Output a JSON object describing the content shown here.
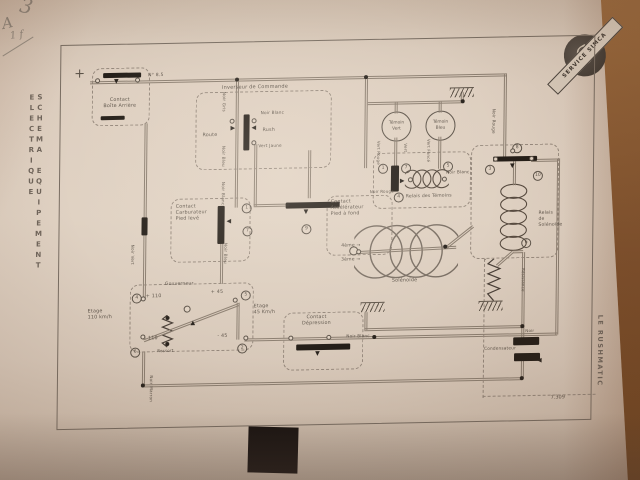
{
  "photo": {
    "handwriting": {
      "mark1": "3",
      "mark2": "A",
      "mark3": "1 f"
    },
    "stamp": {
      "ribbon_text": "SERVICE SIMCA",
      "monogram": "S"
    },
    "colors": {
      "paper": "#dccfc0",
      "wood": "#8a5a33",
      "ink": "#5c5349",
      "wire": "#8b7e70",
      "black": "#241e18"
    }
  },
  "page": {
    "left_margin_title": "SCHEMA EQUIPEMENT ELECTRIQUE",
    "right_margin_title": "LE RUSHMATIC",
    "drawing_number": "7.309"
  },
  "diagram": {
    "temoin_vert": "Témoin\nVert",
    "temoin_bleu": "Témoin\nBleu",
    "labels": [
      {
        "t": "+",
        "x": 74,
        "y": 62,
        "s": 13,
        "n": "plus-terminal-label"
      },
      {
        "t": "Contact\nBoîte Arrière",
        "x": 92,
        "y": 94,
        "w": 56,
        "a": "center",
        "n": "contact-boite-label"
      },
      {
        "t": "N° 8.5",
        "x": 148,
        "y": 70,
        "s": 4.5,
        "n": "wire-gauge-label"
      },
      {
        "t": "Inverseur de Commande",
        "x": 222,
        "y": 83,
        "s": 5,
        "n": "inverseur-label"
      },
      {
        "t": "Route",
        "x": 203,
        "y": 131,
        "n": "route-label"
      },
      {
        "t": "Rush",
        "x": 263,
        "y": 127,
        "n": "rush-label"
      },
      {
        "t": "Noir Blanc",
        "x": 261,
        "y": 109,
        "s": 4.2,
        "n": "wire-label"
      },
      {
        "t": "Vert Jaune",
        "x": 259,
        "y": 142,
        "s": 4.2,
        "n": "wire-label"
      },
      {
        "t": "Noir Gris",
        "x": 227,
        "y": 90,
        "s": 4.2,
        "r": 90,
        "n": "wire-label"
      },
      {
        "t": "Noir Bleu",
        "x": 227,
        "y": 144,
        "s": 4.2,
        "r": 90,
        "n": "wire-label"
      },
      {
        "t": "Noir Blanc",
        "x": 227,
        "y": 180,
        "s": 4.2,
        "r": 90,
        "n": "wire-label"
      },
      {
        "t": "Contact\nCarburateur\nPied levé",
        "x": 177,
        "y": 202,
        "n": "contact-carburateur-label"
      },
      {
        "t": "Contact\nAccélérateur\nPied à fond",
        "x": 332,
        "y": 200,
        "n": "contact-accelerateur-label"
      },
      {
        "t": "Gouverneur",
        "x": 167,
        "y": 279,
        "s": 4.5,
        "n": "gouverneur-label"
      },
      {
        "t": "+ 110",
        "x": 148,
        "y": 291,
        "n": "stage-value"
      },
      {
        "t": "+ 45",
        "x": 213,
        "y": 288,
        "n": "stage-value"
      },
      {
        "t": "- 110",
        "x": 147,
        "y": 333,
        "n": "stage-value"
      },
      {
        "t": "- 45",
        "x": 220,
        "y": 332,
        "n": "stage-value"
      },
      {
        "t": "Ressort",
        "x": 160,
        "y": 345,
        "s": 4,
        "n": "ressort-label"
      },
      {
        "t": "Etage\n110 km/h",
        "x": 90,
        "y": 305,
        "n": "etage-110-label"
      },
      {
        "t": "Etage\n45 Km/h",
        "x": 256,
        "y": 303,
        "n": "etage-45-label"
      },
      {
        "t": "Contact\nDépression",
        "x": 289,
        "y": 315,
        "w": 60,
        "a": "center",
        "n": "contact-depression-label"
      },
      {
        "t": "Noir Blanc",
        "x": 349,
        "y": 334,
        "s": 4.2,
        "n": "wire-label"
      },
      {
        "t": "Relais des Témoins",
        "x": 407,
        "y": 196,
        "s": 4.5,
        "n": "relais-temoins-label"
      },
      {
        "t": "Vert Rouge",
        "x": 382,
        "y": 142,
        "s": 4,
        "r": 90,
        "n": "wire-label"
      },
      {
        "t": "Vert",
        "x": 409,
        "y": 145,
        "s": 4,
        "r": 90,
        "n": "wire-label"
      },
      {
        "t": "Vert Foncé",
        "x": 432,
        "y": 141,
        "s": 4,
        "r": 90,
        "n": "wire-label"
      },
      {
        "t": "Noir Blanc",
        "x": 447,
        "y": 172,
        "s": 4.2,
        "n": "wire-label"
      },
      {
        "t": "Noir Rouge",
        "x": 371,
        "y": 190,
        "s": 4,
        "n": "wire-label"
      },
      {
        "t": "Relais\nde\nSolénoïde",
        "x": 540,
        "y": 215,
        "s": 4.5,
        "n": "relais-solenoide-label"
      },
      {
        "t": "Solénoïde",
        "x": 394,
        "y": 280,
        "n": "solenoide-label"
      },
      {
        "t": "4ème →",
        "x": 343,
        "y": 244,
        "s": 4.5,
        "n": "gear-4-label"
      },
      {
        "t": "3ème →",
        "x": 343,
        "y": 258,
        "s": 4.5,
        "n": "gear-3-label"
      },
      {
        "t": "Résistance",
        "x": 528,
        "y": 272,
        "s": 4,
        "r": 90,
        "n": "resistance-label"
      },
      {
        "t": "Condensateur",
        "x": 487,
        "y": 349,
        "s": 4.2,
        "n": "condensateur-label"
      },
      {
        "t": "Noir",
        "x": 528,
        "y": 332,
        "s": 4,
        "n": "wire-label"
      },
      {
        "t": "Noir Marron",
        "x": 157,
        "y": 372,
        "s": 4.2,
        "r": 90,
        "n": "wire-label"
      },
      {
        "t": "Noir Vert",
        "x": 137,
        "y": 241,
        "s": 4.2,
        "r": 90,
        "n": "wire-label"
      },
      {
        "t": "Noir Bleu",
        "x": 230,
        "y": 241,
        "s": 4.2,
        "r": 90,
        "n": "wire-label"
      },
      {
        "t": "Noir Rouge",
        "x": 497,
        "y": 112,
        "s": 4.2,
        "r": 90,
        "n": "wire-label"
      }
    ],
    "wires": [
      {
        "x": 90,
        "y": 77,
        "w": 417,
        "o": "h"
      },
      {
        "x": 504,
        "y": 78,
        "h": 84,
        "o": "v"
      },
      {
        "x": 145,
        "y": 120,
        "h": 176,
        "o": "v"
      },
      {
        "x": 236,
        "y": 80,
        "h": 126,
        "o": "v"
      },
      {
        "x": 365,
        "y": 80,
        "h": 89,
        "o": "v"
      },
      {
        "x": 368,
        "y": 103,
        "w": 96,
        "o": "h"
      },
      {
        "x": 395,
        "y": 104,
        "h": 11,
        "o": "v"
      },
      {
        "x": 439,
        "y": 104,
        "h": 11,
        "o": "v"
      },
      {
        "x": 461,
        "y": 95,
        "h": 10,
        "o": "v"
      },
      {
        "x": 395,
        "y": 139,
        "h": 30,
        "o": "v"
      },
      {
        "x": 439,
        "y": 139,
        "h": 32,
        "o": "v"
      },
      {
        "x": 255,
        "y": 143,
        "h": 62,
        "o": "v"
      },
      {
        "x": 255,
        "y": 203,
        "w": 32,
        "o": "h"
      },
      {
        "x": 309,
        "y": 150,
        "h": 48,
        "o": "v"
      },
      {
        "x": 222,
        "y": 241,
        "h": 41,
        "o": "v"
      },
      {
        "x": 145,
        "y": 348,
        "h": 36,
        "o": "v"
      },
      {
        "x": 145,
        "y": 381,
        "w": 381,
        "o": "h"
      },
      {
        "x": 294,
        "y": 337,
        "w": 266,
        "o": "h"
      },
      {
        "x": 367,
        "y": 329,
        "w": 158,
        "o": "h"
      },
      {
        "x": 367,
        "y": 313,
        "h": 18,
        "o": "v"
      },
      {
        "x": 524,
        "y": 256,
        "h": 75,
        "o": "v"
      },
      {
        "x": 514,
        "y": 165,
        "h": 24,
        "o": "v"
      },
      {
        "x": 515,
        "y": 254,
        "w": 10,
        "o": "h"
      },
      {
        "x": 532,
        "y": 163,
        "w": 27,
        "o": "h"
      },
      {
        "x": 558,
        "y": 163,
        "h": 176,
        "o": "v"
      },
      {
        "x": 524,
        "y": 331,
        "h": 11,
        "o": "v"
      },
      {
        "x": 524,
        "y": 364,
        "h": 18,
        "o": "v"
      },
      {
        "x": 239,
        "y": 301,
        "h": 37,
        "o": "v"
      },
      {
        "x": 247,
        "y": 337,
        "w": 48,
        "o": "h"
      },
      {
        "x": 146,
        "y": 336,
        "w": 101,
        "r": -20,
        "o": "h",
        "n": "governor-lever"
      },
      {
        "x": 352,
        "y": 252,
        "w": 106,
        "r": -2,
        "o": "h",
        "n": "solenoid-axis"
      },
      {
        "x": 447,
        "y": 249,
        "w": 34,
        "r": -38,
        "o": "h",
        "n": "solenoid-link"
      },
      {
        "x": 498,
        "y": 268,
        "w": 21,
        "r": -41,
        "o": "h"
      }
    ],
    "dashed_boxes": [
      {
        "x": 92,
        "y": 64,
        "w": 56,
        "h": 56,
        "n": "contact-boite-box"
      },
      {
        "x": 196,
        "y": 90,
        "w": 134,
        "h": 76,
        "n": "inverseur-box"
      },
      {
        "x": 172,
        "y": 196,
        "w": 78,
        "h": 62,
        "n": "carburateur-box"
      },
      {
        "x": 328,
        "y": 196,
        "w": 64,
        "h": 58,
        "n": "accelerateur-box"
      },
      {
        "x": 132,
        "y": 281,
        "w": 122,
        "h": 66,
        "n": "gouverneur-box"
      },
      {
        "x": 286,
        "y": 312,
        "w": 78,
        "h": 56,
        "n": "depression-box"
      },
      {
        "x": 374,
        "y": 154,
        "w": 96,
        "h": 54,
        "n": "relais-temoins-box"
      },
      {
        "x": 472,
        "y": 148,
        "w": 86,
        "h": 112,
        "n": "relais-solenoide-box"
      }
    ],
    "dash_lines": [
      {
        "x": 486,
        "y": 262,
        "w": 1,
        "h": 138
      },
      {
        "x": 486,
        "y": 399,
        "w": 112,
        "h": 1
      }
    ],
    "bars": [
      {
        "x": 103,
        "y": 69,
        "w": 38,
        "h": 5,
        "n": "battery-contact-bar"
      },
      {
        "x": 101,
        "y": 112,
        "w": 24,
        "h": 4
      },
      {
        "x": 244,
        "y": 113,
        "w": 6,
        "h": 36,
        "n": "inverseur-switch-bar"
      },
      {
        "x": 219,
        "y": 204,
        "w": 7,
        "h": 38,
        "n": "carburateur-contact-bar"
      },
      {
        "x": 287,
        "y": 202,
        "w": 54,
        "h": 6,
        "n": "accelerateur-contact-bar"
      },
      {
        "x": 299,
        "y": 344,
        "w": 54,
        "h": 6,
        "n": "depression-contact-bar"
      },
      {
        "x": 392,
        "y": 167,
        "w": 8,
        "h": 26,
        "n": "temoins-contact-bar"
      },
      {
        "x": 494,
        "y": 160,
        "w": 44,
        "h": 5,
        "n": "relay-contact-bar"
      },
      {
        "x": 516,
        "y": 341,
        "w": 26,
        "h": 8,
        "n": "condensateur-plate"
      },
      {
        "x": 517,
        "y": 357,
        "w": 26,
        "h": 8,
        "n": "condensateur-plate"
      },
      {
        "x": 143,
        "y": 214,
        "w": 6,
        "h": 18,
        "n": "wire-connector"
      }
    ],
    "arrows": [
      {
        "x": 114,
        "y": 75,
        "g": "▼"
      },
      {
        "x": 231,
        "y": 124,
        "g": "▶"
      },
      {
        "x": 252,
        "y": 124,
        "g": "◀"
      },
      {
        "x": 228,
        "y": 217,
        "g": "◀"
      },
      {
        "x": 305,
        "y": 209,
        "g": "▼"
      },
      {
        "x": 318,
        "y": 351,
        "g": "▼"
      },
      {
        "x": 511,
        "y": 167,
        "g": "▼"
      },
      {
        "x": 401,
        "y": 180,
        "g": "▶"
      },
      {
        "x": 193,
        "y": 318,
        "g": "▲"
      },
      {
        "x": 540,
        "y": 362,
        "g": "◀"
      }
    ],
    "circled_numbers": [
      {
        "n": "4",
        "x": 134,
        "y": 290
      },
      {
        "n": "5",
        "x": 243,
        "y": 289
      },
      {
        "n": "2",
        "x": 240,
        "y": 342
      },
      {
        "n": "6",
        "x": 133,
        "y": 344
      },
      {
        "n": "1",
        "x": 243,
        "y": 202
      },
      {
        "n": "7",
        "x": 244,
        "y": 225
      },
      {
        "n": "9",
        "x": 303,
        "y": 224
      },
      {
        "n": "1",
        "x": 379,
        "y": 165
      },
      {
        "n": "7",
        "x": 402,
        "y": 165
      },
      {
        "n": "5",
        "x": 444,
        "y": 164
      },
      {
        "n": "4",
        "x": 395,
        "y": 194
      },
      {
        "n": "3",
        "x": 486,
        "y": 168
      },
      {
        "n": "8",
        "x": 513,
        "y": 147
      },
      {
        "n": "10",
        "x": 534,
        "y": 175
      },
      {
        "n": "6",
        "x": 523,
        "y": 242
      }
    ],
    "terminals": [
      {
        "x": 95,
        "y": 74
      },
      {
        "x": 135,
        "y": 74
      },
      {
        "x": 230,
        "y": 117
      },
      {
        "x": 252,
        "y": 117
      },
      {
        "x": 252,
        "y": 139
      },
      {
        "x": 143,
        "y": 293
      },
      {
        "x": 235,
        "y": 296
      },
      {
        "x": 186,
        "y": 303,
        "d": 7
      },
      {
        "x": 291,
        "y": 335
      },
      {
        "x": 329,
        "y": 335
      },
      {
        "x": 409,
        "y": 179
      },
      {
        "x": 443,
        "y": 179
      },
      {
        "x": 494,
        "y": 160
      },
      {
        "x": 530,
        "y": 160
      },
      {
        "x": 511,
        "y": 152
      },
      {
        "x": 351,
        "y": 247,
        "d": 9
      },
      {
        "x": 358,
        "y": 250,
        "d": 5
      },
      {
        "x": 246,
        "y": 334
      },
      {
        "x": 143,
        "y": 331
      }
    ],
    "dots": [
      {
        "x": 235,
        "y": 76
      },
      {
        "x": 364,
        "y": 76
      },
      {
        "x": 375,
        "y": 336
      },
      {
        "x": 523,
        "y": 328
      },
      {
        "x": 523,
        "y": 380
      },
      {
        "x": 144,
        "y": 380
      },
      {
        "x": 461,
        "y": 102
      },
      {
        "x": 287,
        "y": 202
      },
      {
        "x": 445,
        "y": 247
      }
    ],
    "grounds": [
      {
        "x": 450,
        "y": 90
      },
      {
        "x": 363,
        "y": 303
      },
      {
        "x": 481,
        "y": 304
      }
    ]
  }
}
